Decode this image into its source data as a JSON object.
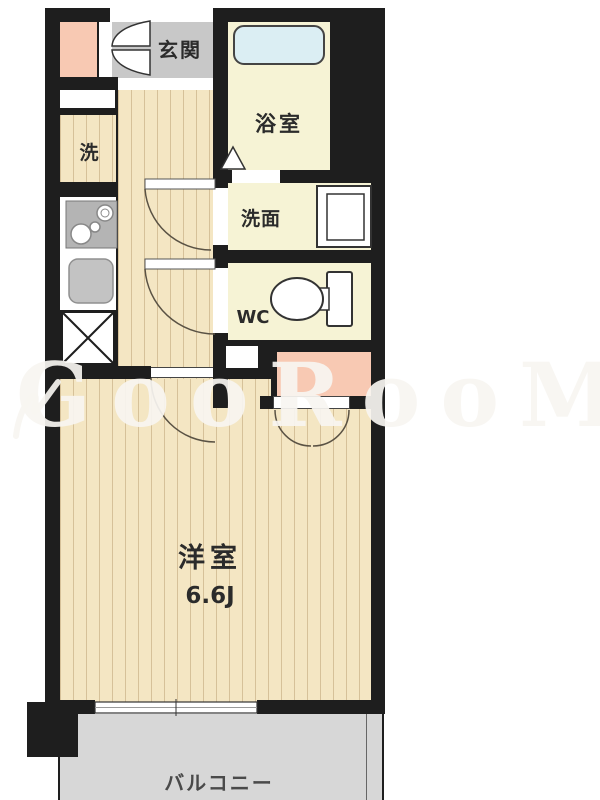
{
  "plan": {
    "rooms": {
      "genkan": "玄関",
      "bath": "浴室",
      "laundry": "洗",
      "washroom": "洗面",
      "wc": "WC",
      "main_room": "洋室",
      "main_room_size": "6.6J",
      "balcony": "バルコニー"
    },
    "watermark": "GooRooM",
    "colors": {
      "wall": "#1e1e1e",
      "wood_floor": "#f4e6c3",
      "room_yellow": "#f6f3d5",
      "genkan_gray": "#c8c8c8",
      "balcony_gray": "#d7d7d7",
      "closet_pink": "#f8c9b3",
      "bathtub_blue": "#dbeef3"
    }
  }
}
